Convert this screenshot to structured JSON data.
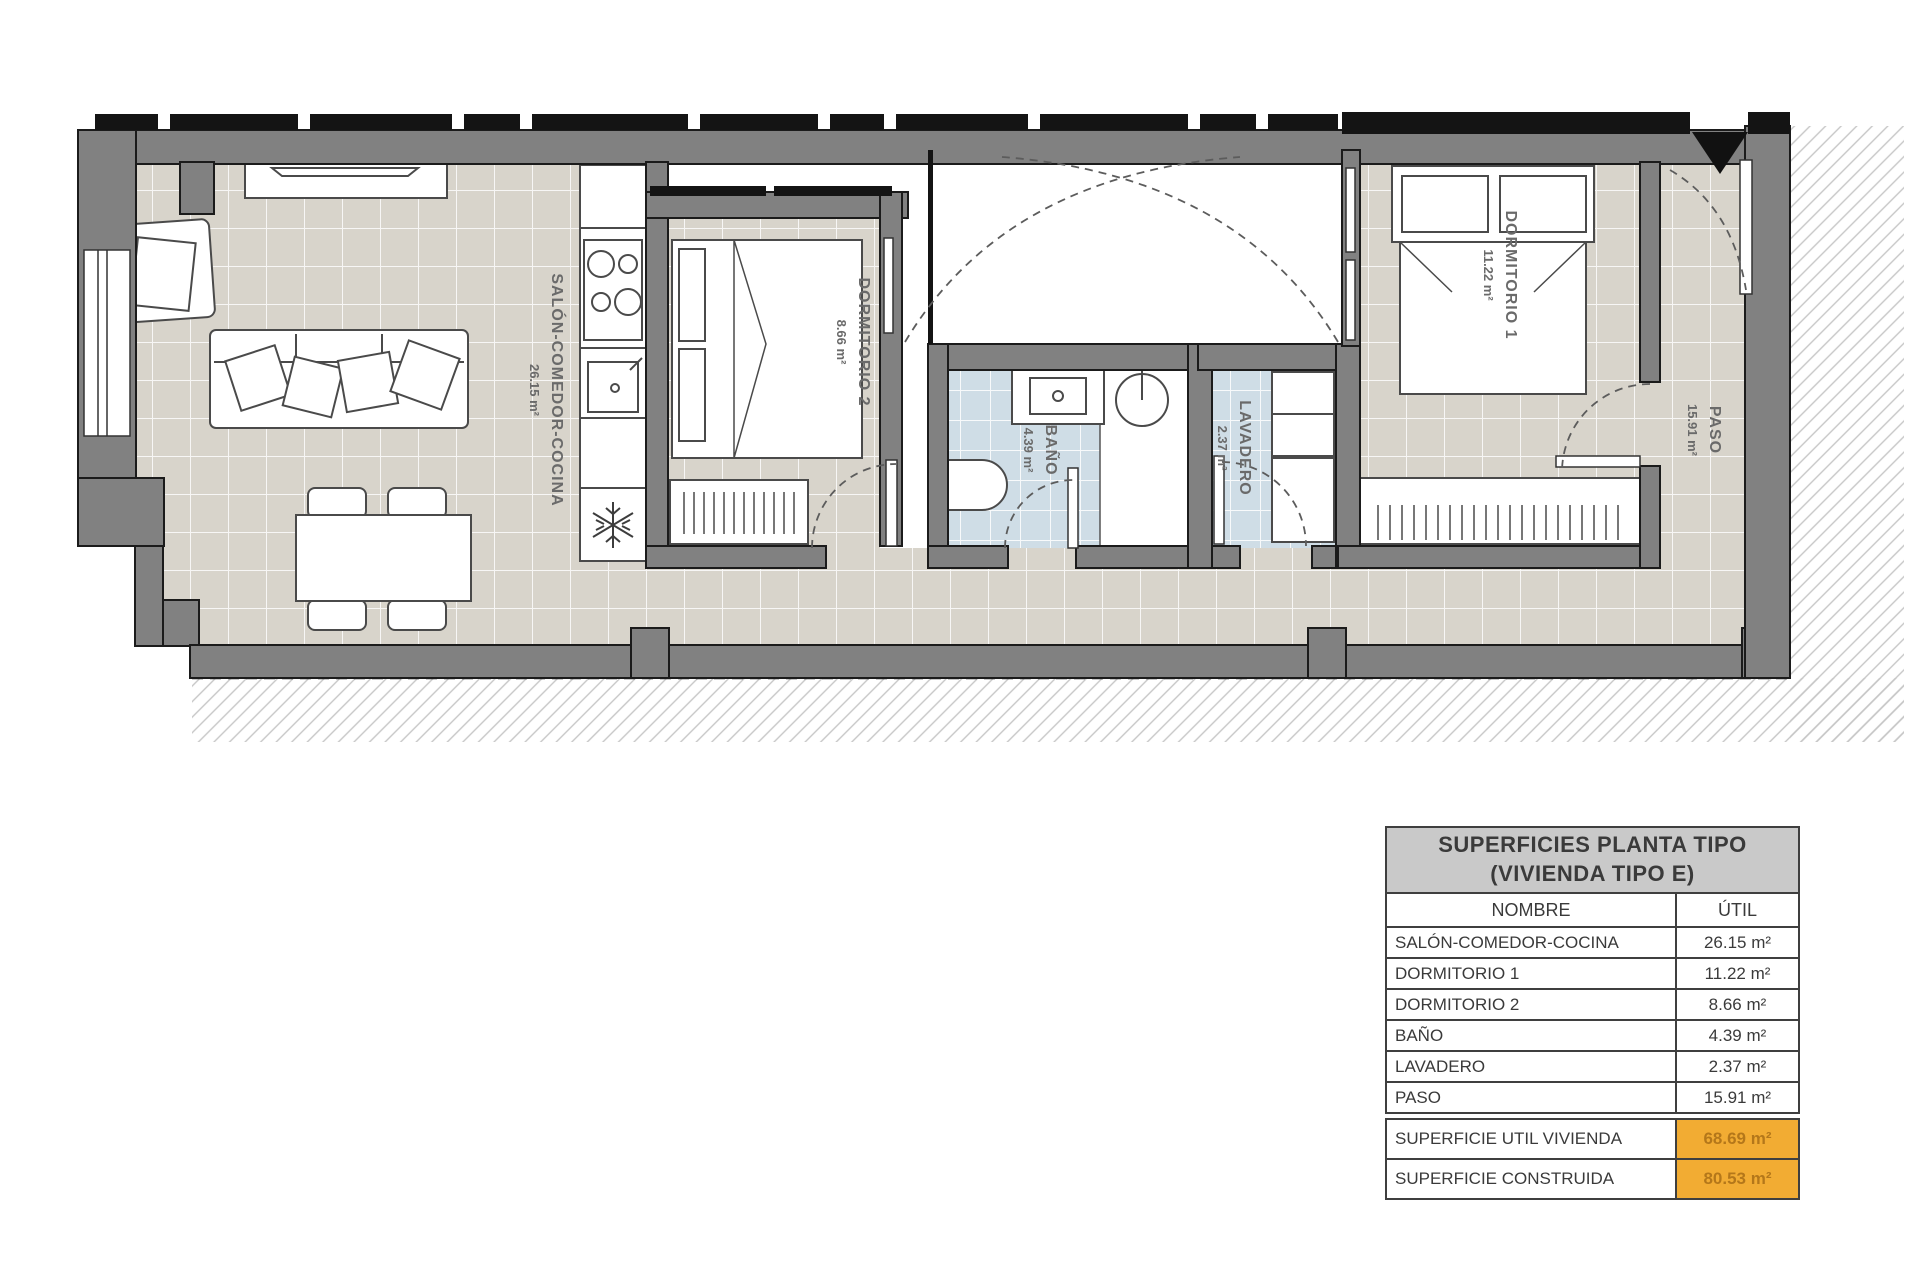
{
  "plan": {
    "rooms": [
      {
        "name": "SALÓN-COMEDOR-COCINA",
        "area": "26.15 m²"
      },
      {
        "name": "DORMITORIO 2",
        "area": "8.66 m²"
      },
      {
        "name": "BAÑO",
        "area": "4.39 m²"
      },
      {
        "name": "LAVADERO",
        "area": "2.37 m²"
      },
      {
        "name": "DORMITORIO 1",
        "area": "11.22 m²"
      },
      {
        "name": "PASO",
        "area": "15.91 m²"
      }
    ],
    "colors": {
      "floor_tile": "#d8d4cb",
      "wet_room_tile": "#cfdde6",
      "wall": "#818181",
      "accent_orange": "#F2AC33"
    }
  },
  "table": {
    "title_line1": "SUPERFICIES PLANTA TIPO",
    "title_line2": "(VIVIENDA TIPO E)",
    "col_name": "NOMBRE",
    "col_util": "ÚTIL",
    "rows": [
      {
        "name": "SALÓN-COMEDOR-COCINA",
        "util": "26.15 m²"
      },
      {
        "name": "DORMITORIO 1",
        "util": "11.22 m²"
      },
      {
        "name": "DORMITORIO 2",
        "util": "8.66 m²"
      },
      {
        "name": "BAÑO",
        "util": "4.39 m²"
      },
      {
        "name": "LAVADERO",
        "util": "2.37 m²"
      },
      {
        "name": "PASO",
        "util": "15.91 m²"
      }
    ],
    "totals": [
      {
        "label": "SUPERFICIE UTIL VIVIENDA",
        "value": "68.69 m²"
      },
      {
        "label": "SUPERFICIE CONSTRUIDA",
        "value": "80.53 m²"
      }
    ]
  }
}
